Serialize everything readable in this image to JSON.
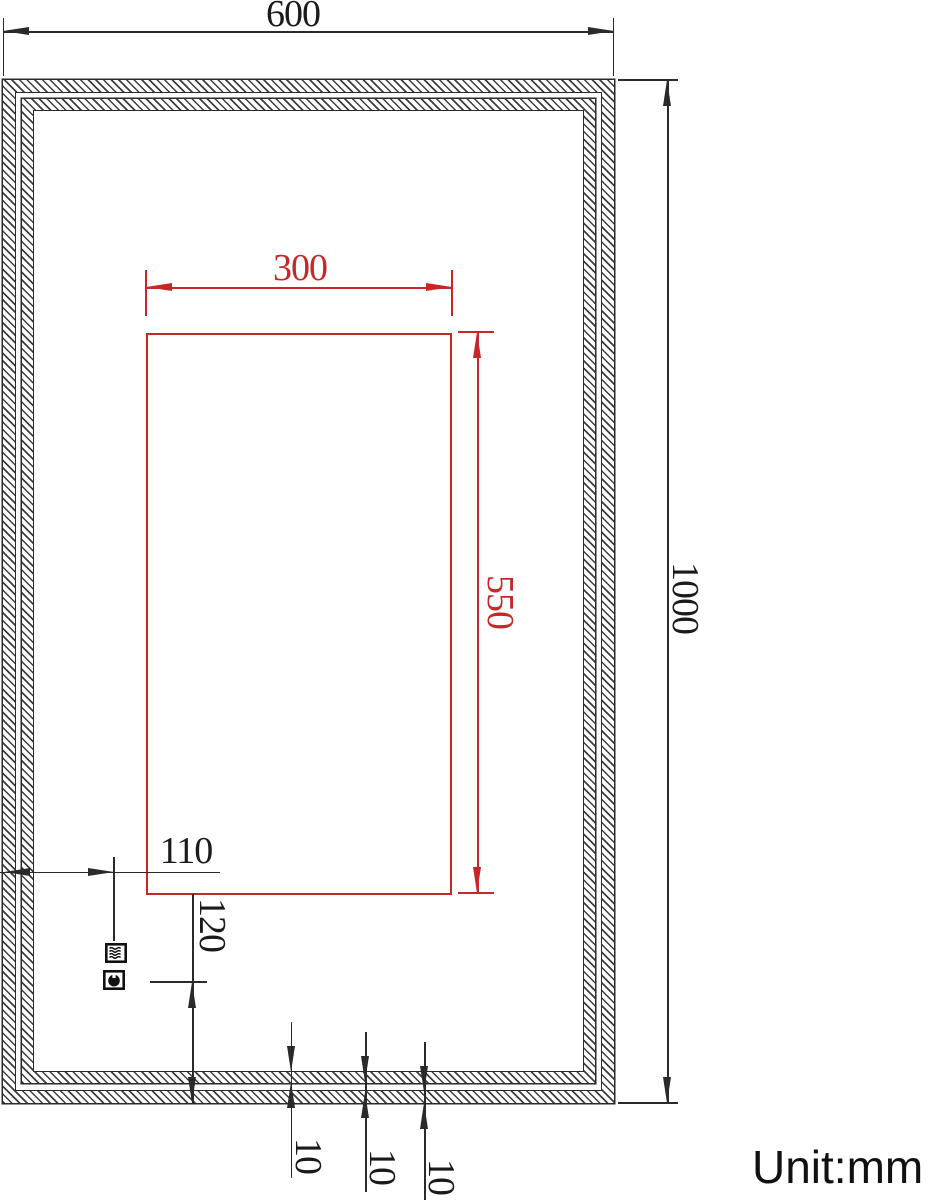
{
  "drawing": {
    "title": "mirror-dimension-drawing",
    "unit_label": "Unit:mm",
    "colors": {
      "line": "#2a2a2a",
      "dimension_red": "#c62828"
    },
    "dims": {
      "overall_width": "600",
      "overall_height": "1000",
      "window_width": "300",
      "window_height": "550",
      "icon_offset_x": "110",
      "icon_offset_y": "120",
      "inner_strip": "10",
      "strip_gap": "10",
      "outer_strip": "10"
    },
    "icons": [
      {
        "name": "defogger-icon"
      },
      {
        "name": "touch-sensor-icon"
      }
    ]
  }
}
